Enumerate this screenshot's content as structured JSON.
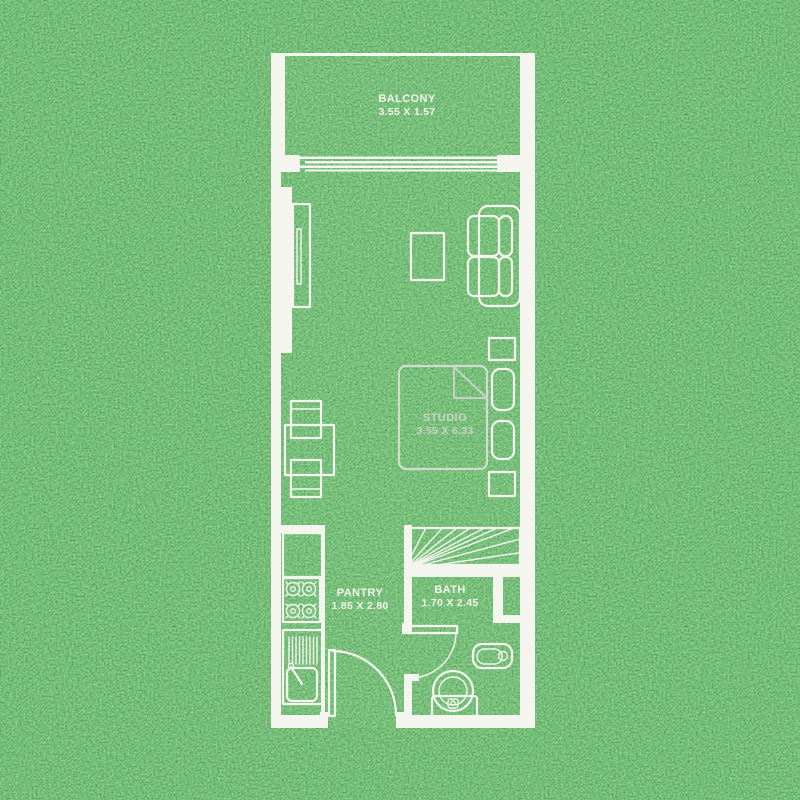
{
  "canvas": {
    "width": 800,
    "height": 800
  },
  "colors": {
    "grass_base": "#2f6e31",
    "grass_dark": "#1c4a1e",
    "grass_light": "#58a352",
    "line": "#f4f5ef",
    "text": "#f2f4ec",
    "dim_text": "#ccd2c8"
  },
  "rooms": [
    {
      "name": "BALCONY",
      "dims": "3.55 X 1.57"
    },
    {
      "name": "STUDIO",
      "dims": "3.55 X 6.33"
    },
    {
      "name": "PANTRY",
      "dims": "1.85 X 2.80"
    },
    {
      "name": "BATH",
      "dims": "1.70 X 2.45"
    }
  ]
}
